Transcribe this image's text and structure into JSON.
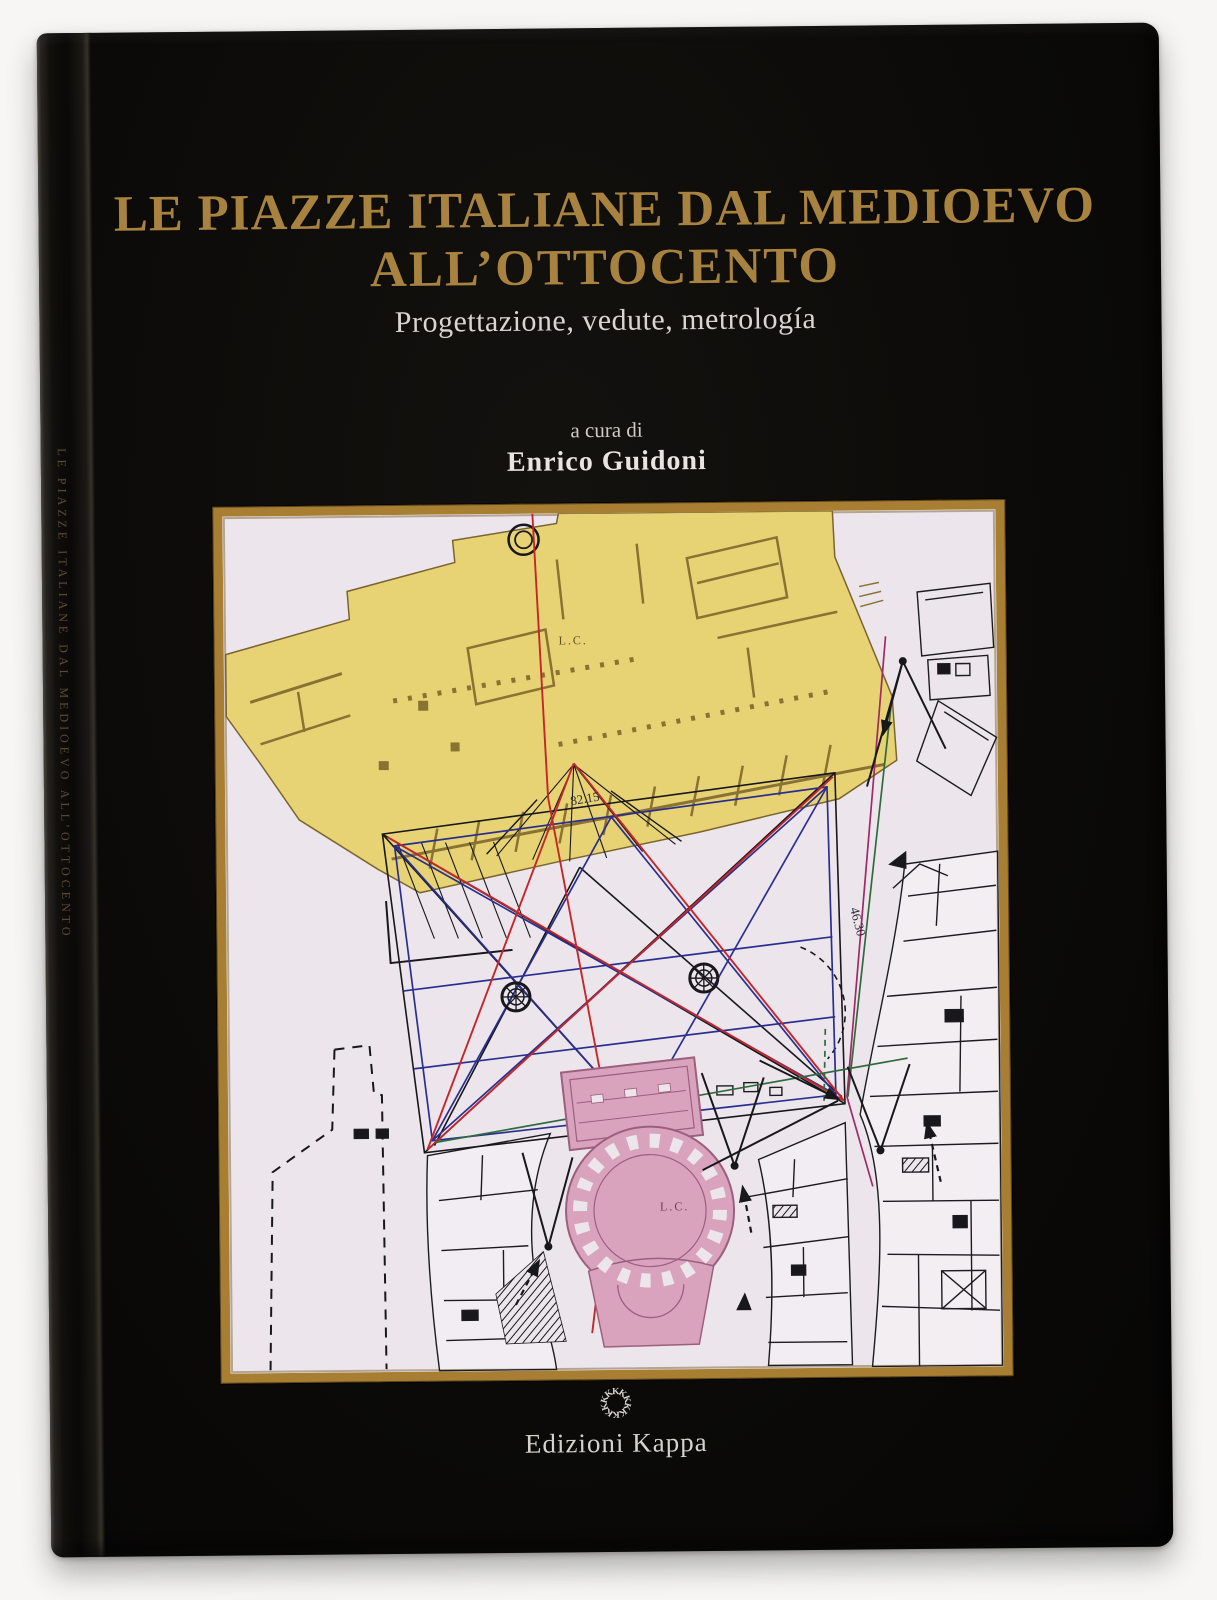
{
  "cover": {
    "title_line1": "LE PIAZZE ITALIANE DAL MEDIOEVO",
    "title_line2": "ALL’OTTOCENTO",
    "subtitle": "Progettazione, vedute, metrología",
    "byline": "a cura di",
    "author": "Enrico Guidoni"
  },
  "spine": {
    "title": "LE PIAZZE ITALIANE DAL MEDIOEVO ALL’OTTOCENTO"
  },
  "publisher": {
    "name": "Edizioni Kappa",
    "logo": "ring of K letters",
    "logo_letter": "K"
  },
  "plan": {
    "labels": {
      "lc_palace": "L.C.",
      "lc_rotunda": "L.C.",
      "measure_top": "82.15",
      "measure_right": "46.30"
    }
  },
  "colors": {
    "cover_black": "#0b0a08",
    "title_gold": "#a8823f",
    "subtitle_white": "#d9d5d0",
    "frame_gold": "#a87e33",
    "plan_background": "#ece5ec",
    "palace_yellow": "#e7d374",
    "palace_wall": "#8a7233",
    "piazza_pink": "#d9a3bd",
    "line_red": "#c3272b",
    "line_blue": "#2a2f8e",
    "line_green": "#2f6b3d",
    "line_magenta": "#9e2a66"
  }
}
